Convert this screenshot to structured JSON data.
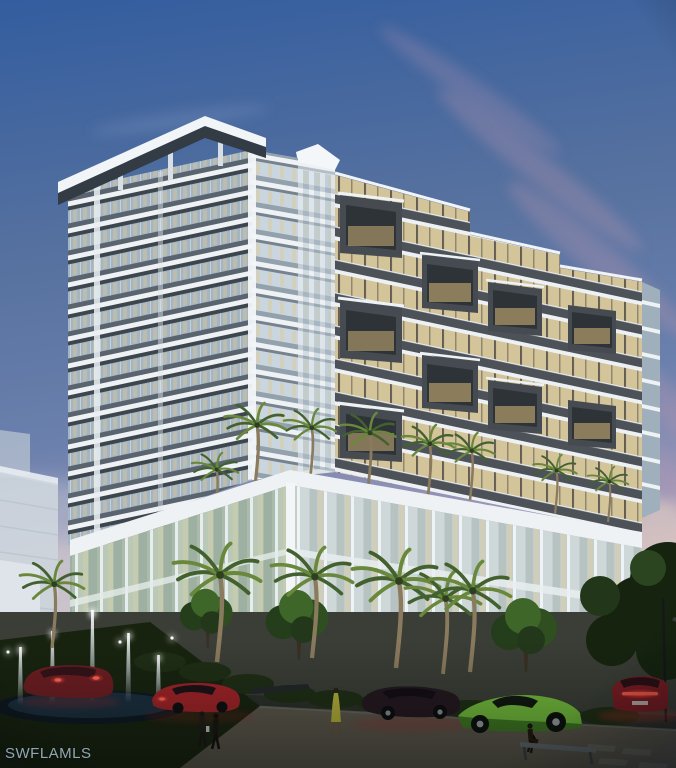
{
  "watermark": {
    "text": "SWFLAMLS"
  },
  "palette": {
    "sky_top": "#335d9f",
    "sky_mid": "#6b80ad",
    "sky_horizon": "#d4b9c0",
    "cloud_pink": "#bd97af",
    "building_white": "#eef2f5",
    "facade_shadow": "#3d454d",
    "glass_cool": "#a3b4c2",
    "glass_warm": "#ddc795",
    "hood_gray": "#454b51",
    "podium_glass": "#b7c6bb",
    "storefront_wood": "#b98f58",
    "palm_green": "#42612f",
    "palm_light": "#69883b",
    "tree_green": "#2c451f",
    "lawn_dark": "#18230f",
    "road": "#2c302a",
    "sidewalk": "#5d635c",
    "water_jet": "#e9f4fb",
    "car_red": "#a32328",
    "car_dark_red": "#6e1d22",
    "car_maroon": "#241820",
    "car_green": "#74bd3c",
    "taillight": "#ff4038",
    "watermark_color": "#a9bfcf"
  }
}
